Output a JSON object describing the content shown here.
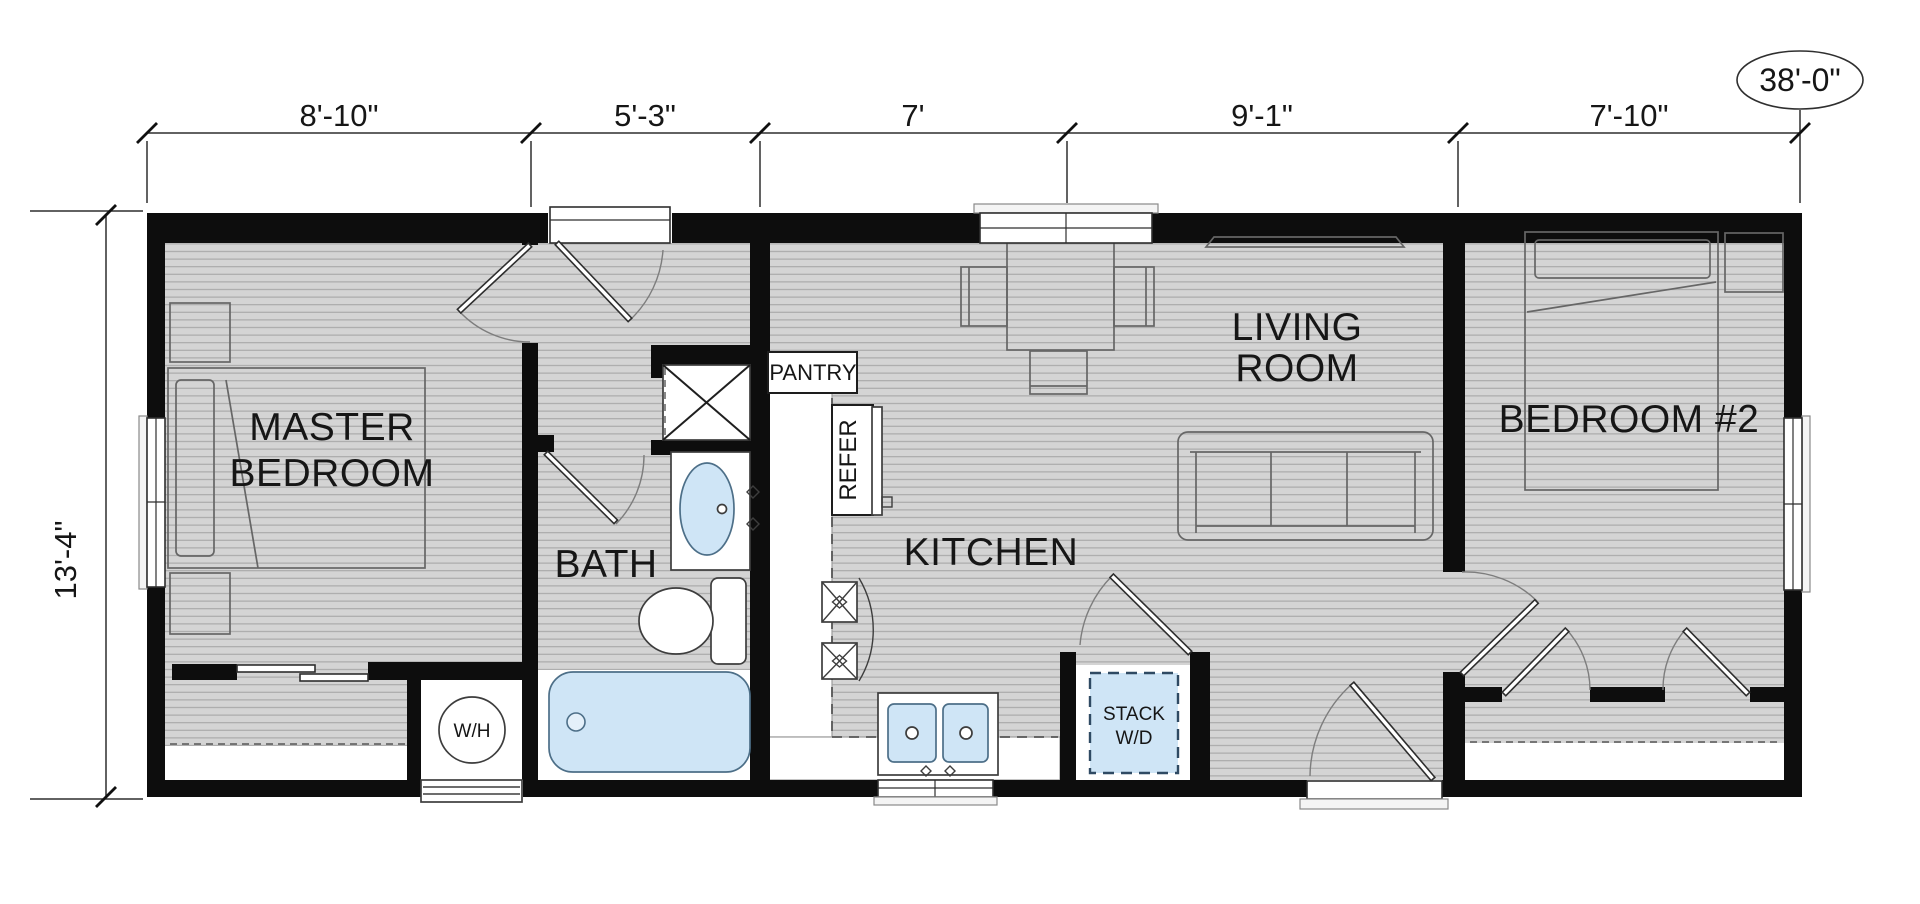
{
  "plan": {
    "type": "floor_plan",
    "total_width_label": "38'-0\"",
    "height_label": "13'-4\"",
    "top_dimensions": [
      "8'-10\"",
      "5'-3\"",
      "7'",
      "9'-1\"",
      "7'-10\""
    ],
    "rooms": {
      "master_bedroom": {
        "line1": "MASTER",
        "line2": "BEDROOM"
      },
      "bath": {
        "label": "BATH"
      },
      "kitchen": {
        "label": "KITCHEN"
      },
      "living_room": {
        "line1": "LIVING",
        "line2": "ROOM"
      },
      "bedroom2": {
        "label": "BEDROOM #2"
      }
    },
    "fixtures": {
      "pantry": "PANTRY",
      "refrigerator": "REFER",
      "water_heater": "W/H",
      "washer_dryer_line1": "STACK",
      "washer_dryer_line2": "W/D"
    },
    "colors": {
      "wall": "#0d0d0d",
      "floor": "#d4d4d4",
      "floor_line": "#a6a6a6",
      "fixture_blue": "#cfe5f6"
    }
  }
}
